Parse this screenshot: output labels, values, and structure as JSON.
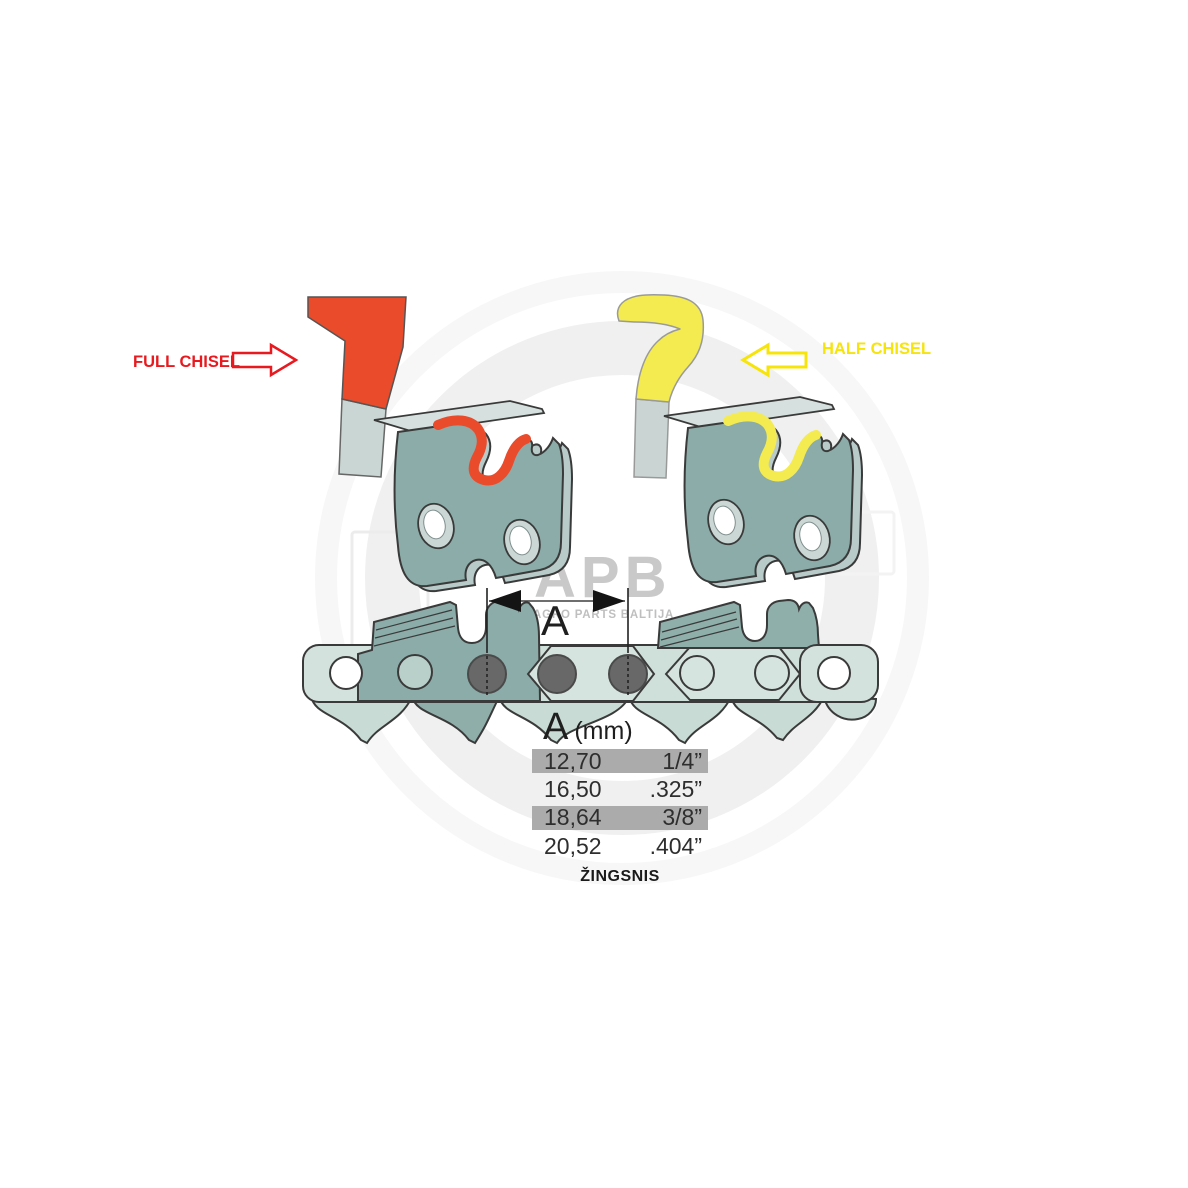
{
  "watermark": {
    "brand": "APB",
    "subtitle": "AGRO PARTS BALTIJA"
  },
  "annotations": {
    "full_chisel_label": "FULL CHISEL",
    "half_chisel_label": "HALF CHISEL"
  },
  "dimension": {
    "label": "A"
  },
  "pitch_table": {
    "header_symbol": "A",
    "header_unit": "(mm)",
    "rows": [
      {
        "mm": "12,70",
        "inch": "1/4”",
        "highlighted": true
      },
      {
        "mm": "16,50",
        "inch": ".325”",
        "highlighted": false
      },
      {
        "mm": "18,64",
        "inch": "3/8”",
        "highlighted": true
      },
      {
        "mm": "20,52",
        "inch": ".404”",
        "highlighted": false
      }
    ],
    "caption": "ŽINGSNIS"
  },
  "colors": {
    "full_chisel": "#E94B2B",
    "half_chisel": "#F3EB4F",
    "label_red": "#E8191F",
    "label_yellow": "#F6E40A",
    "cutter_teal": "#8BACA8",
    "cutter_side": "#B9CBC9",
    "top_plate": "#D6E0DE",
    "link_light": "#CFE0DA",
    "link_lighter": "#D6E4DF",
    "rivet_gray": "#686868",
    "row_highlight": "#ABABAB",
    "outline": "#3A3A3A"
  }
}
